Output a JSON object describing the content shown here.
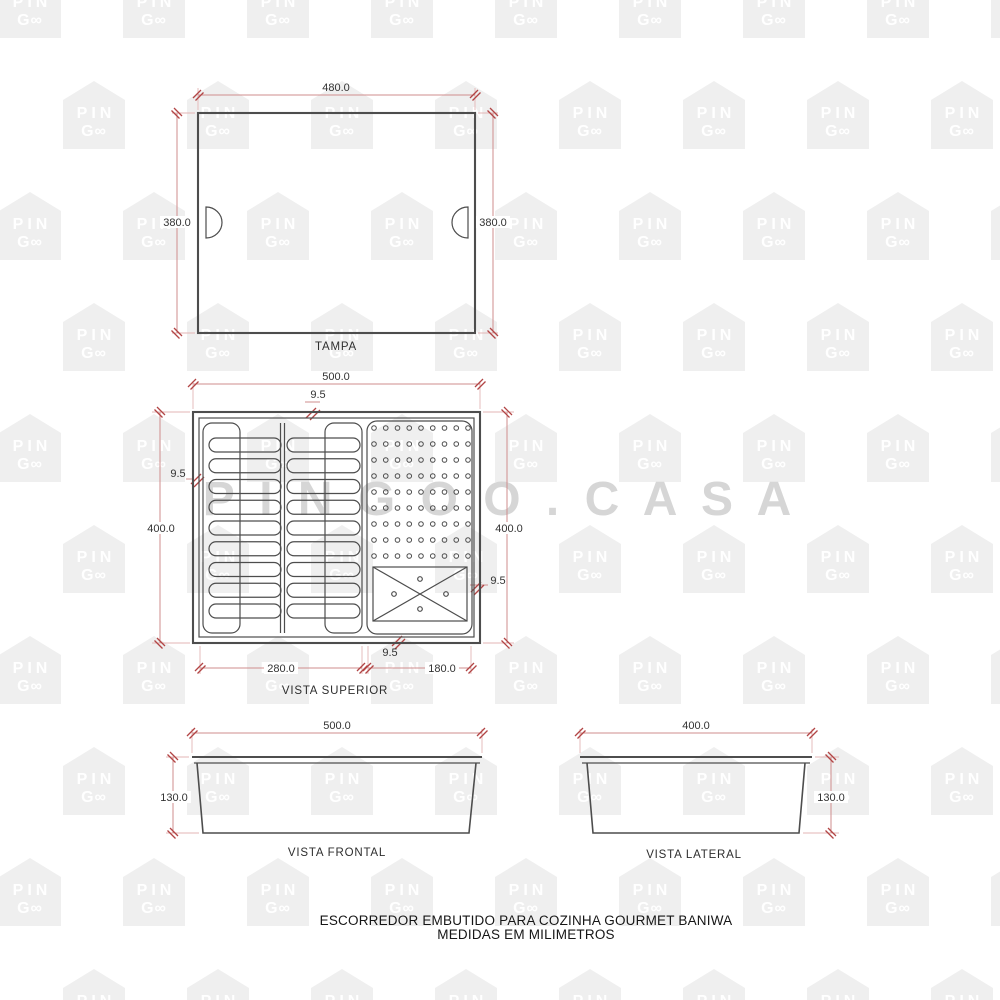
{
  "watermark": {
    "tile_line1": "PIN",
    "tile_line2": "G∞",
    "big_text": "P I N G O O . C A S A"
  },
  "views": {
    "tampa": {
      "label": "TAMPA",
      "width_dim": "480.0",
      "height_dim_left": "380.0",
      "height_dim_right": "380.0",
      "handle_count": 2
    },
    "superior": {
      "label": "VISTA SUPERIOR",
      "width_dim": "500.0",
      "height_dim_left": "400.0",
      "height_dim_right": "400.0",
      "wall_dim_top": "9.5",
      "wall_dim_left": "9.5",
      "wall_dim_right": "9.5",
      "wall_dim_bottom": "9.5",
      "bottom_left_dim": "280.0",
      "bottom_right_dim": "180.0",
      "slot_columns": 2,
      "slots_per_column": 9,
      "dot_grid_rows": 9,
      "dot_grid_cols": 9,
      "drain_box_dots": 4
    },
    "frontal": {
      "label": "VISTA FRONTAL",
      "width_dim": "500.0",
      "height_dim": "130.0"
    },
    "lateral": {
      "label": "VISTA LATERAL",
      "width_dim": "400.0",
      "height_dim": "130.0"
    }
  },
  "title": {
    "line1": "ESCORREDOR EMBUTIDO PARA COZINHA GOURMET BANIWA",
    "line2": "MEDIDAS EM MILIMETROS"
  },
  "colors": {
    "outline": "#4d4d4d",
    "dim_line": "#cf8d8d",
    "dim_accent": "#b24545",
    "dim_text": "#333333",
    "watermark_tile": "#efefef",
    "watermark_text": "#ffffff",
    "watermark_big": "#d6d6d6"
  }
}
